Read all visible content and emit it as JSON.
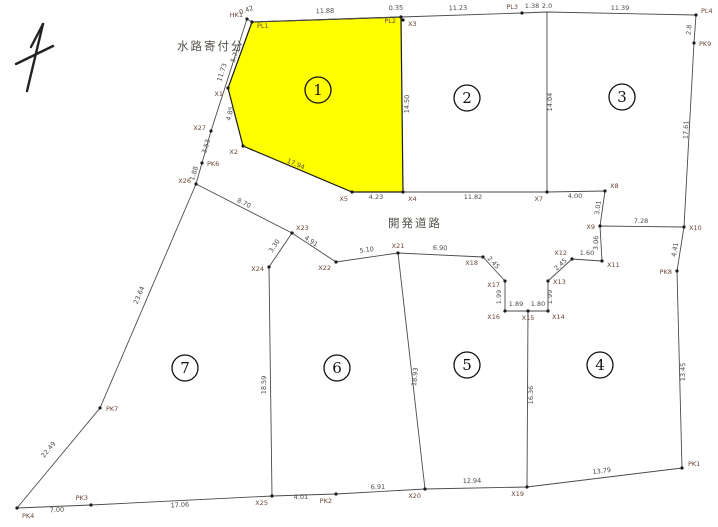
{
  "map": {
    "background": "#ffffff",
    "line_color": "#4a4a4a",
    "point_color": "#1c1c1c",
    "point_label_color": "#6a4534",
    "distance_label_color": "#4f4a44",
    "highlight_fill": "#ffff00",
    "annotations": {
      "water_channel_label": "水路寄付分",
      "road_label": "開発道路"
    },
    "parcel_numbers": [
      {
        "n": "1",
        "x": 318,
        "y": 90
      },
      {
        "n": "2",
        "x": 467,
        "y": 98
      },
      {
        "n": "3",
        "x": 622,
        "y": 97
      },
      {
        "n": "4",
        "x": 600,
        "y": 365
      },
      {
        "n": "5",
        "x": 467,
        "y": 365
      },
      {
        "n": "6",
        "x": 337,
        "y": 368
      },
      {
        "n": "7",
        "x": 185,
        "y": 368
      }
    ],
    "highlight_parcel": {
      "id": "1",
      "points": [
        [
          252,
          22
        ],
        [
          401,
          17
        ],
        [
          403,
          192
        ],
        [
          352,
          192
        ],
        [
          243,
          146
        ],
        [
          228,
          88
        ]
      ]
    },
    "segments": [
      {
        "id": "top-boundary",
        "pts": [
          [
            252,
            22
          ],
          [
            401,
            17
          ],
          [
            522,
            13
          ],
          [
            547,
            12
          ],
          [
            696,
            15
          ]
        ]
      },
      {
        "id": "right-boundary",
        "pts": [
          [
            696,
            15
          ],
          [
            694,
            43
          ],
          [
            684,
            227
          ],
          [
            677,
            271
          ],
          [
            682,
            468
          ]
        ]
      },
      {
        "id": "bottom-boundary",
        "pts": [
          [
            682,
            468
          ],
          [
            527,
            487
          ],
          [
            425,
            489
          ],
          [
            336,
            494
          ],
          [
            272,
            496
          ],
          [
            91,
            505
          ],
          [
            17,
            508
          ]
        ]
      },
      {
        "id": "left-boundary",
        "pts": [
          [
            17,
            508
          ],
          [
            100,
            408
          ],
          [
            196,
            184
          ]
        ]
      },
      {
        "id": "channel-outer-line",
        "pts": [
          [
            196,
            184
          ],
          [
            202,
            163
          ],
          [
            211,
            131
          ],
          [
            247,
            19
          ]
        ]
      },
      {
        "id": "channel-top-tie",
        "pts": [
          [
            247,
            19
          ],
          [
            252,
            22
          ]
        ]
      },
      {
        "id": "divider-2-3",
        "pts": [
          [
            547,
            12
          ],
          [
            547,
            192
          ]
        ]
      },
      {
        "id": "road-north-edge",
        "pts": [
          [
            403,
            192
          ],
          [
            547,
            192
          ],
          [
            605,
            191
          ]
        ]
      },
      {
        "id": "road-east-end",
        "pts": [
          [
            605,
            191
          ],
          [
            600,
            226
          ]
        ]
      },
      {
        "id": "road-stub-to-boundary",
        "pts": [
          [
            600,
            226
          ],
          [
            684,
            227
          ]
        ]
      },
      {
        "id": "parcel4-northwest-corner",
        "pts": [
          [
            600,
            226
          ],
          [
            602,
            261
          ]
        ]
      },
      {
        "id": "turnaround-notch",
        "pts": [
          [
            602,
            261
          ],
          [
            572,
            259
          ],
          [
            548,
            281
          ],
          [
            548,
            311
          ],
          [
            528,
            311
          ],
          [
            505,
            311
          ],
          [
            505,
            281
          ],
          [
            483,
            257
          ]
        ]
      },
      {
        "id": "road-south-edge",
        "pts": [
          [
            483,
            257
          ],
          [
            398,
            253
          ],
          [
            336,
            262
          ],
          [
            292,
            233
          ]
        ]
      },
      {
        "id": "parcel7-north-edge",
        "pts": [
          [
            292,
            233
          ],
          [
            196,
            184
          ]
        ]
      },
      {
        "id": "divider-7-6-neck",
        "pts": [
          [
            292,
            233
          ],
          [
            269,
            267
          ]
        ]
      },
      {
        "id": "divider-7-6",
        "pts": [
          [
            269,
            267
          ],
          [
            272,
            496
          ]
        ]
      },
      {
        "id": "divider-6-5",
        "pts": [
          [
            398,
            253
          ],
          [
            425,
            489
          ]
        ]
      },
      {
        "id": "divider-5-4",
        "pts": [
          [
            528,
            311
          ],
          [
            527,
            487
          ]
        ]
      }
    ],
    "survey_points": [
      {
        "id": "HK1",
        "x": 247,
        "y": 19,
        "lx": 243,
        "ly": 17,
        "anchor": "end"
      },
      {
        "id": "PL1",
        "x": 252,
        "y": 22,
        "lx": 257,
        "ly": 28,
        "anchor": "start"
      },
      {
        "id": "PL2",
        "x": 401,
        "y": 17,
        "lx": 396,
        "ly": 23,
        "anchor": "end"
      },
      {
        "id": "X3",
        "x": 403,
        "y": 20,
        "lx": 408,
        "ly": 26,
        "anchor": "start"
      },
      {
        "id": "PL3",
        "x": 522,
        "y": 13,
        "lx": 518,
        "ly": 9,
        "anchor": "end"
      },
      {
        "id": "PL4",
        "x": 696,
        "y": 15,
        "lx": 701,
        "ly": 13,
        "anchor": "start"
      },
      {
        "id": "PK9",
        "x": 694,
        "y": 43,
        "lx": 699,
        "ly": 46,
        "anchor": "start"
      },
      {
        "id": "X10",
        "x": 684,
        "y": 227,
        "lx": 689,
        "ly": 230,
        "anchor": "start"
      },
      {
        "id": "PK8",
        "x": 677,
        "y": 271,
        "lx": 672,
        "ly": 274,
        "anchor": "end"
      },
      {
        "id": "PK1",
        "x": 682,
        "y": 468,
        "lx": 688,
        "ly": 466,
        "anchor": "start"
      },
      {
        "id": "X19",
        "x": 527,
        "y": 487,
        "lx": 524,
        "ly": 496,
        "anchor": "end"
      },
      {
        "id": "X20",
        "x": 425,
        "y": 489,
        "lx": 421,
        "ly": 498,
        "anchor": "end"
      },
      {
        "id": "PK2",
        "x": 336,
        "y": 494,
        "lx": 332,
        "ly": 503,
        "anchor": "end"
      },
      {
        "id": "X25",
        "x": 272,
        "y": 496,
        "lx": 268,
        "ly": 505,
        "anchor": "end"
      },
      {
        "id": "PK3",
        "x": 91,
        "y": 505,
        "lx": 88,
        "ly": 500,
        "anchor": "end"
      },
      {
        "id": "PK4",
        "x": 17,
        "y": 508,
        "lx": 22,
        "ly": 518,
        "anchor": "start"
      },
      {
        "id": "PK7",
        "x": 100,
        "y": 408,
        "lx": 106,
        "ly": 411,
        "anchor": "start"
      },
      {
        "id": "X26",
        "x": 196,
        "y": 184,
        "lx": 191,
        "ly": 183,
        "anchor": "end"
      },
      {
        "id": "PK6",
        "x": 202,
        "y": 163,
        "lx": 207,
        "ly": 166,
        "anchor": "start"
      },
      {
        "id": "X27",
        "x": 211,
        "y": 131,
        "lx": 206,
        "ly": 130,
        "anchor": "end"
      },
      {
        "id": "X1",
        "x": 228,
        "y": 88,
        "lx": 223,
        "ly": 96,
        "anchor": "end"
      },
      {
        "id": "X2",
        "x": 243,
        "y": 146,
        "lx": 238,
        "ly": 154,
        "anchor": "end"
      },
      {
        "id": "X5",
        "x": 352,
        "y": 192,
        "lx": 348,
        "ly": 201,
        "anchor": "end"
      },
      {
        "id": "X4",
        "x": 403,
        "y": 192,
        "lx": 408,
        "ly": 201,
        "anchor": "start"
      },
      {
        "id": "X7",
        "x": 547,
        "y": 192,
        "lx": 543,
        "ly": 201,
        "anchor": "end"
      },
      {
        "id": "X8",
        "x": 605,
        "y": 191,
        "lx": 610,
        "ly": 188,
        "anchor": "start"
      },
      {
        "id": "X9",
        "x": 600,
        "y": 226,
        "lx": 595,
        "ly": 229,
        "anchor": "end"
      },
      {
        "id": "X11",
        "x": 602,
        "y": 261,
        "lx": 607,
        "ly": 267,
        "anchor": "start"
      },
      {
        "id": "X12",
        "x": 572,
        "y": 259,
        "lx": 567,
        "ly": 255,
        "anchor": "end"
      },
      {
        "id": "X13",
        "x": 548,
        "y": 281,
        "lx": 553,
        "ly": 284,
        "anchor": "start"
      },
      {
        "id": "X14",
        "x": 548,
        "y": 311,
        "lx": 552,
        "ly": 319,
        "anchor": "start"
      },
      {
        "id": "X15",
        "x": 528,
        "y": 311,
        "lx": 528,
        "ly": 320,
        "anchor": "middle"
      },
      {
        "id": "X16",
        "x": 505,
        "y": 311,
        "lx": 500,
        "ly": 319,
        "anchor": "end"
      },
      {
        "id": "X17",
        "x": 505,
        "y": 281,
        "lx": 500,
        "ly": 287,
        "anchor": "end"
      },
      {
        "id": "X18",
        "x": 483,
        "y": 257,
        "lx": 478,
        "ly": 265,
        "anchor": "end"
      },
      {
        "id": "X21",
        "x": 398,
        "y": 253,
        "lx": 398,
        "ly": 248,
        "anchor": "middle"
      },
      {
        "id": "X22",
        "x": 336,
        "y": 262,
        "lx": 331,
        "ly": 270,
        "anchor": "end"
      },
      {
        "id": "X23",
        "x": 292,
        "y": 233,
        "lx": 296,
        "ly": 230,
        "anchor": "start"
      },
      {
        "id": "X24",
        "x": 269,
        "y": 267,
        "lx": 264,
        "ly": 271,
        "anchor": "end"
      }
    ],
    "distance_labels": [
      {
        "v": "0.42",
        "x": 247,
        "y": 12,
        "rot": -20
      },
      {
        "v": "11.88",
        "x": 325,
        "y": 13,
        "rot": -2
      },
      {
        "v": "0.35",
        "x": 396,
        "y": 10,
        "rot": -2
      },
      {
        "v": "11.23",
        "x": 458,
        "y": 10,
        "rot": -2
      },
      {
        "v": "1.38",
        "x": 532,
        "y": 8,
        "rot": 0
      },
      {
        "v": "2.0",
        "x": 547,
        "y": 8,
        "rot": 0
      },
      {
        "v": "11.39",
        "x": 620,
        "y": 10,
        "rot": 0
      },
      {
        "v": "2.8",
        "x": 691,
        "y": 30,
        "rot": -85
      },
      {
        "v": "17.61",
        "x": 688,
        "y": 130,
        "rot": -87
      },
      {
        "v": "7.28",
        "x": 641,
        "y": 223,
        "rot": 0
      },
      {
        "v": "4.41",
        "x": 677,
        "y": 250,
        "rot": -80
      },
      {
        "v": "13.45",
        "x": 685,
        "y": 372,
        "rot": -89
      },
      {
        "v": "13.79",
        "x": 602,
        "y": 473,
        "rot": -7
      },
      {
        "v": "12.94",
        "x": 472,
        "y": 483,
        "rot": -1
      },
      {
        "v": "6.91",
        "x": 378,
        "y": 489,
        "rot": -2
      },
      {
        "v": "4.01",
        "x": 301,
        "y": 499,
        "rot": -2
      },
      {
        "v": "17.06",
        "x": 180,
        "y": 507,
        "rot": -3
      },
      {
        "v": "7.00",
        "x": 57,
        "y": 512,
        "rot": -3
      },
      {
        "v": "22.49",
        "x": 50,
        "y": 451,
        "rot": -50
      },
      {
        "v": "23.64",
        "x": 141,
        "y": 296,
        "rot": -67
      },
      {
        "v": "11.73",
        "x": 224,
        "y": 73,
        "rot": -72
      },
      {
        "v": "3.53",
        "x": 208,
        "y": 147,
        "rot": -73
      },
      {
        "v": "1.88",
        "x": 196,
        "y": 174,
        "rot": -73
      },
      {
        "v": "5.71",
        "x": 237,
        "y": 56,
        "rot": -70
      },
      {
        "v": "4.85",
        "x": 232,
        "y": 114,
        "rot": -76
      },
      {
        "v": "17.94",
        "x": 295,
        "y": 166,
        "rot": 23
      },
      {
        "v": "4.23",
        "x": 376,
        "y": 199,
        "rot": 0
      },
      {
        "v": "11.82",
        "x": 473,
        "y": 199,
        "rot": 0
      },
      {
        "v": "4.00",
        "x": 575,
        "y": 198,
        "rot": 0
      },
      {
        "v": "14.50",
        "x": 409,
        "y": 104,
        "rot": -89
      },
      {
        "v": "14.04",
        "x": 552,
        "y": 102,
        "rot": -90
      },
      {
        "v": "3.01",
        "x": 600,
        "y": 208,
        "rot": -82
      },
      {
        "v": "3.06",
        "x": 598,
        "y": 243,
        "rot": -87
      },
      {
        "v": "1.60",
        "x": 587,
        "y": 255,
        "rot": 0
      },
      {
        "v": "2.45",
        "x": 562,
        "y": 266,
        "rot": -42
      },
      {
        "v": "1.99",
        "x": 552,
        "y": 297,
        "rot": -90
      },
      {
        "v": "1.80",
        "x": 538,
        "y": 306,
        "rot": 0
      },
      {
        "v": "1.89",
        "x": 516,
        "y": 306,
        "rot": 0
      },
      {
        "v": "1.99",
        "x": 501,
        "y": 297,
        "rot": -90
      },
      {
        "v": "2.45",
        "x": 492,
        "y": 264,
        "rot": 47
      },
      {
        "v": "6.90",
        "x": 440,
        "y": 250,
        "rot": 2
      },
      {
        "v": "5.10",
        "x": 367,
        "y": 252,
        "rot": -8
      },
      {
        "v": "4.91",
        "x": 310,
        "y": 243,
        "rot": 33
      },
      {
        "v": "8.70",
        "x": 243,
        "y": 205,
        "rot": 27
      },
      {
        "v": "3.30",
        "x": 276,
        "y": 247,
        "rot": -56
      },
      {
        "v": "18.59",
        "x": 266,
        "y": 385,
        "rot": -89
      },
      {
        "v": "18.93",
        "x": 417,
        "y": 377,
        "rot": -84
      },
      {
        "v": "16.36",
        "x": 533,
        "y": 395,
        "rot": -90
      }
    ]
  }
}
